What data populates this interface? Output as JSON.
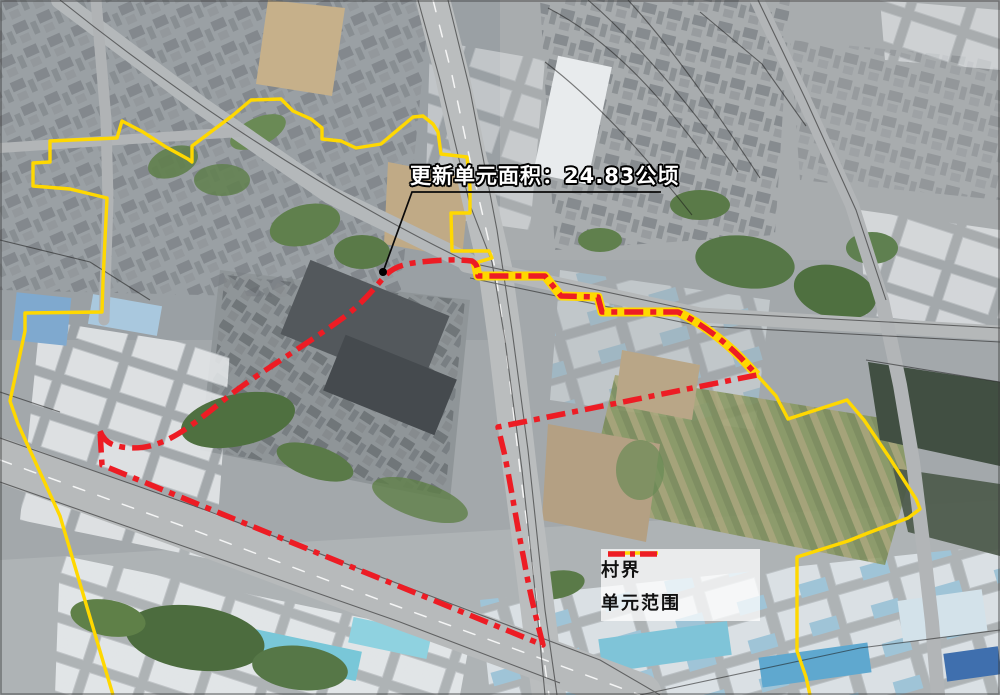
{
  "figure": {
    "type": "satellite-planning-map",
    "annotation": {
      "area_label": "更新单元面积：24.83公顷",
      "anchor_dot_color": "#000000",
      "text_color": "#ffffff",
      "outline_color": "#000000"
    },
    "legend": {
      "items": [
        {
          "id": "village-boundary",
          "label": "村界",
          "color": "#ffd800",
          "line_style": "solid"
        },
        {
          "id": "unit-scope",
          "label": "单元范围",
          "color": "#ed1c24",
          "line_style": "dash-dot"
        }
      ]
    }
  }
}
